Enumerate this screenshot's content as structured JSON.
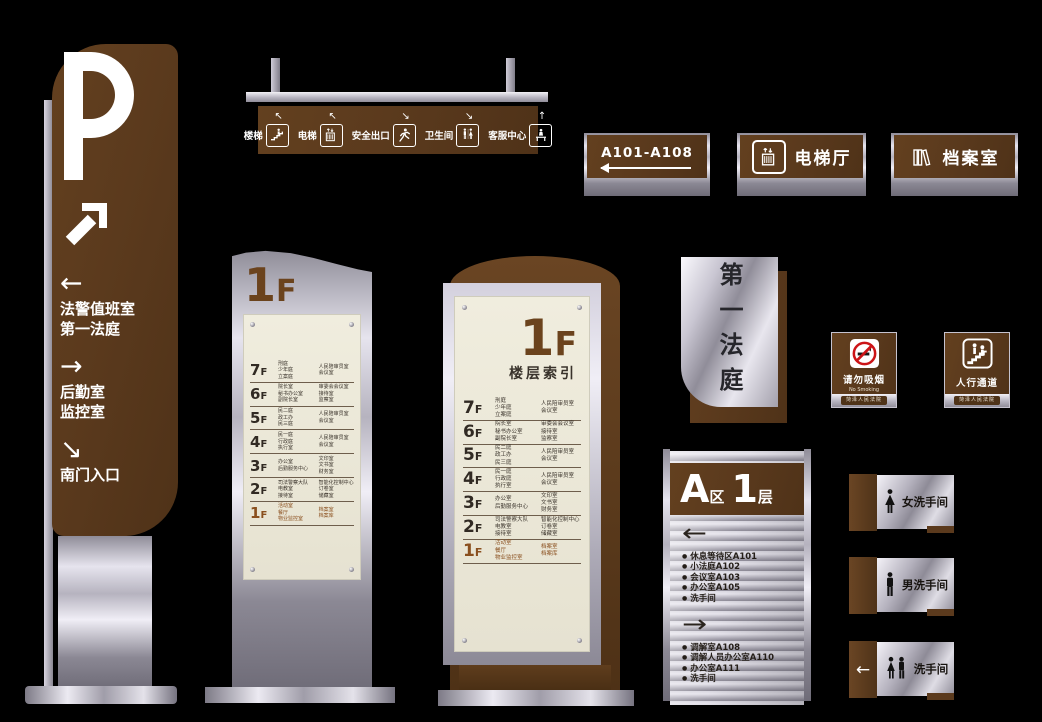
{
  "colors": {
    "background": "#000000",
    "brown": "#5b3a1d",
    "brown_light": "#6a4523",
    "metal_light": "#eceaf2",
    "metal_dark": "#76737f",
    "cream": "#ece8da",
    "accent_red": "#cc1417",
    "text_dark": "#2b2722",
    "floor_highlight": "#8a4f1e"
  },
  "parking_pylon": {
    "letter": "P",
    "entries": [
      {
        "arrow": "←",
        "lines": [
          "法警值班室",
          "第一法庭"
        ]
      },
      {
        "arrow": "→",
        "lines": [
          "后勤室",
          "监控室"
        ]
      },
      {
        "arrow": "↘",
        "lines": [
          "南门入口"
        ]
      }
    ]
  },
  "hanging_sign": {
    "items": [
      {
        "arrow": "↖",
        "label": "楼梯",
        "icon": "stairs-icon"
      },
      {
        "arrow": "↖",
        "label": "电梯",
        "icon": "elevator-icon"
      },
      {
        "arrow": "↘",
        "label": "安全出口",
        "icon": "exit-run-icon"
      },
      {
        "arrow": "↘",
        "label": "卫生间",
        "icon": "toilet-pair-icon"
      },
      {
        "arrow": "↑",
        "label": "客服中心",
        "icon": "service-desk-icon"
      }
    ]
  },
  "wall_signs": {
    "range_sign": {
      "label": "A101-A108"
    },
    "elevator_sign": {
      "label": "电梯厅",
      "icon": "elevator-icon"
    },
    "archive_sign": {
      "label": "档案室",
      "icon": "archive-icon"
    }
  },
  "directory_small": {
    "floor_digit": "1",
    "floor_suffix": "F"
  },
  "directory_large": {
    "floor_digit": "1",
    "floor_suffix": "F",
    "subtitle": "楼层索引"
  },
  "floors": [
    {
      "num": "7",
      "f": "F",
      "col1": [
        "刑庭",
        "少年庭",
        "立案庭"
      ],
      "col2": [
        "人民陪审员室",
        "会议室"
      ],
      "highlight": false
    },
    {
      "num": "6",
      "f": "F",
      "col1": [
        "院长室",
        "秘书办公室",
        "副院长室"
      ],
      "col2": [
        "审委会会议室",
        "接待室",
        "监察室"
      ],
      "highlight": false
    },
    {
      "num": "5",
      "f": "F",
      "col1": [
        "民二庭",
        "政工办",
        "民三庭"
      ],
      "col2": [
        "人民陪审员室",
        "会议室"
      ],
      "highlight": false
    },
    {
      "num": "4",
      "f": "F",
      "col1": [
        "民一庭",
        "行政庭",
        "执行室"
      ],
      "col2": [
        "人民陪审员室",
        "会议室"
      ],
      "highlight": false
    },
    {
      "num": "3",
      "f": "F",
      "col1": [
        "办公室",
        "后勤服务中心"
      ],
      "col2": [
        "文印室",
        "文书室",
        "财务室"
      ],
      "highlight": false
    },
    {
      "num": "2",
      "f": "F",
      "col1": [
        "司法警察大队",
        "电教室",
        "接待室"
      ],
      "col2": [
        "智能化控制中心",
        "订卷室",
        "储藏室"
      ],
      "highlight": false
    },
    {
      "num": "1",
      "f": "F",
      "col1": [
        "活动室",
        "餐厅",
        "物业监控室"
      ],
      "col2": [
        "档案室",
        "档案库"
      ],
      "highlight": true
    }
  ],
  "court_sign": {
    "label": "第一法庭"
  },
  "no_smoking_sign": {
    "title": "请勿吸烟",
    "subtitle": "No Smoking",
    "footer": "菏泽人民法院",
    "icon": "no-smoking-icon"
  },
  "pedestrian_sign": {
    "title": "人行通道",
    "footer": "菏泽人民法院",
    "icon": "pedestrian-passage-icon"
  },
  "zone_directory": {
    "zone": "A",
    "zone_suffix": "区",
    "floor": "1",
    "floor_suffix": "层",
    "groups": [
      {
        "arrow": "←",
        "items": [
          "休息等待区A101",
          "小法庭A102",
          "会议室A103",
          "办公室A105",
          "洗手间"
        ]
      },
      {
        "arrow": "→",
        "items": [
          "调解室A108",
          "调解人员办公室A110",
          "办公室A111",
          "洗手间"
        ]
      }
    ]
  },
  "restroom_signs": [
    {
      "label": "女洗手间",
      "icon": "female-icon",
      "arrow": ""
    },
    {
      "label": "男洗手间",
      "icon": "male-icon",
      "arrow": ""
    },
    {
      "label": "洗手间",
      "icon": "family-icon",
      "arrow": "←"
    }
  ]
}
